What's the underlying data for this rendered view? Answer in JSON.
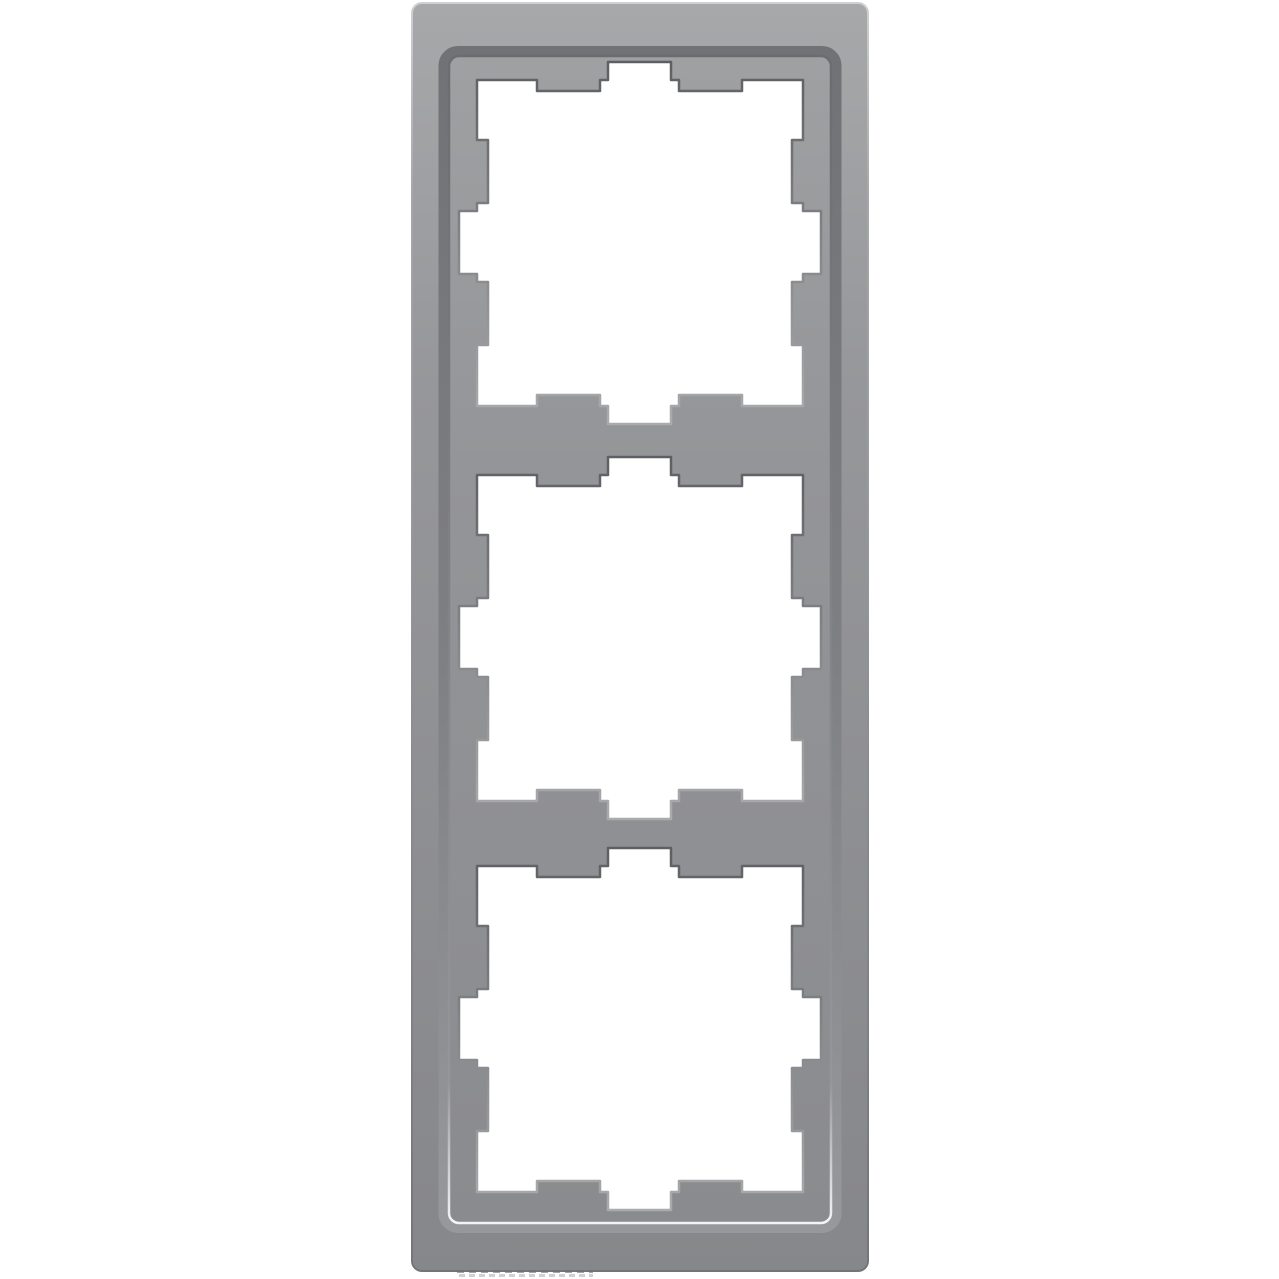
{
  "image": {
    "description": "Gray three-gang cover frame for wall switches, portrait orientation, on a plain white background",
    "gang_count": 3
  },
  "colors": {
    "background": "#ffffff",
    "aperture_fill": "#ffffff",
    "frame_light": "#a7a8aa",
    "frame_base": "#96979a",
    "frame_dark": "#86878a",
    "outline_light": "#cfd0d2",
    "outline_mid": "#a6a7a9",
    "outline_dark": "#747578",
    "bevel_top": "#717276",
    "bevel_mid": "#7e7f83",
    "bevel_bottom": "#97989b",
    "plateau_light": "#9fa0a2",
    "plateau_base": "#949598",
    "plateau_dark": "#8a8b8e",
    "edge_dark": "#6b6c6f",
    "edge_mid": "#959699",
    "edge_bright": "#d8d9db",
    "edge_highlight": "#f3f4f6",
    "cut_shadow": "#5e5f62",
    "cut_mid": "#7c7d80",
    "cut_light": "#aaabad",
    "emboss_dark": "#707174",
    "emboss_light": "#c9cacc"
  }
}
